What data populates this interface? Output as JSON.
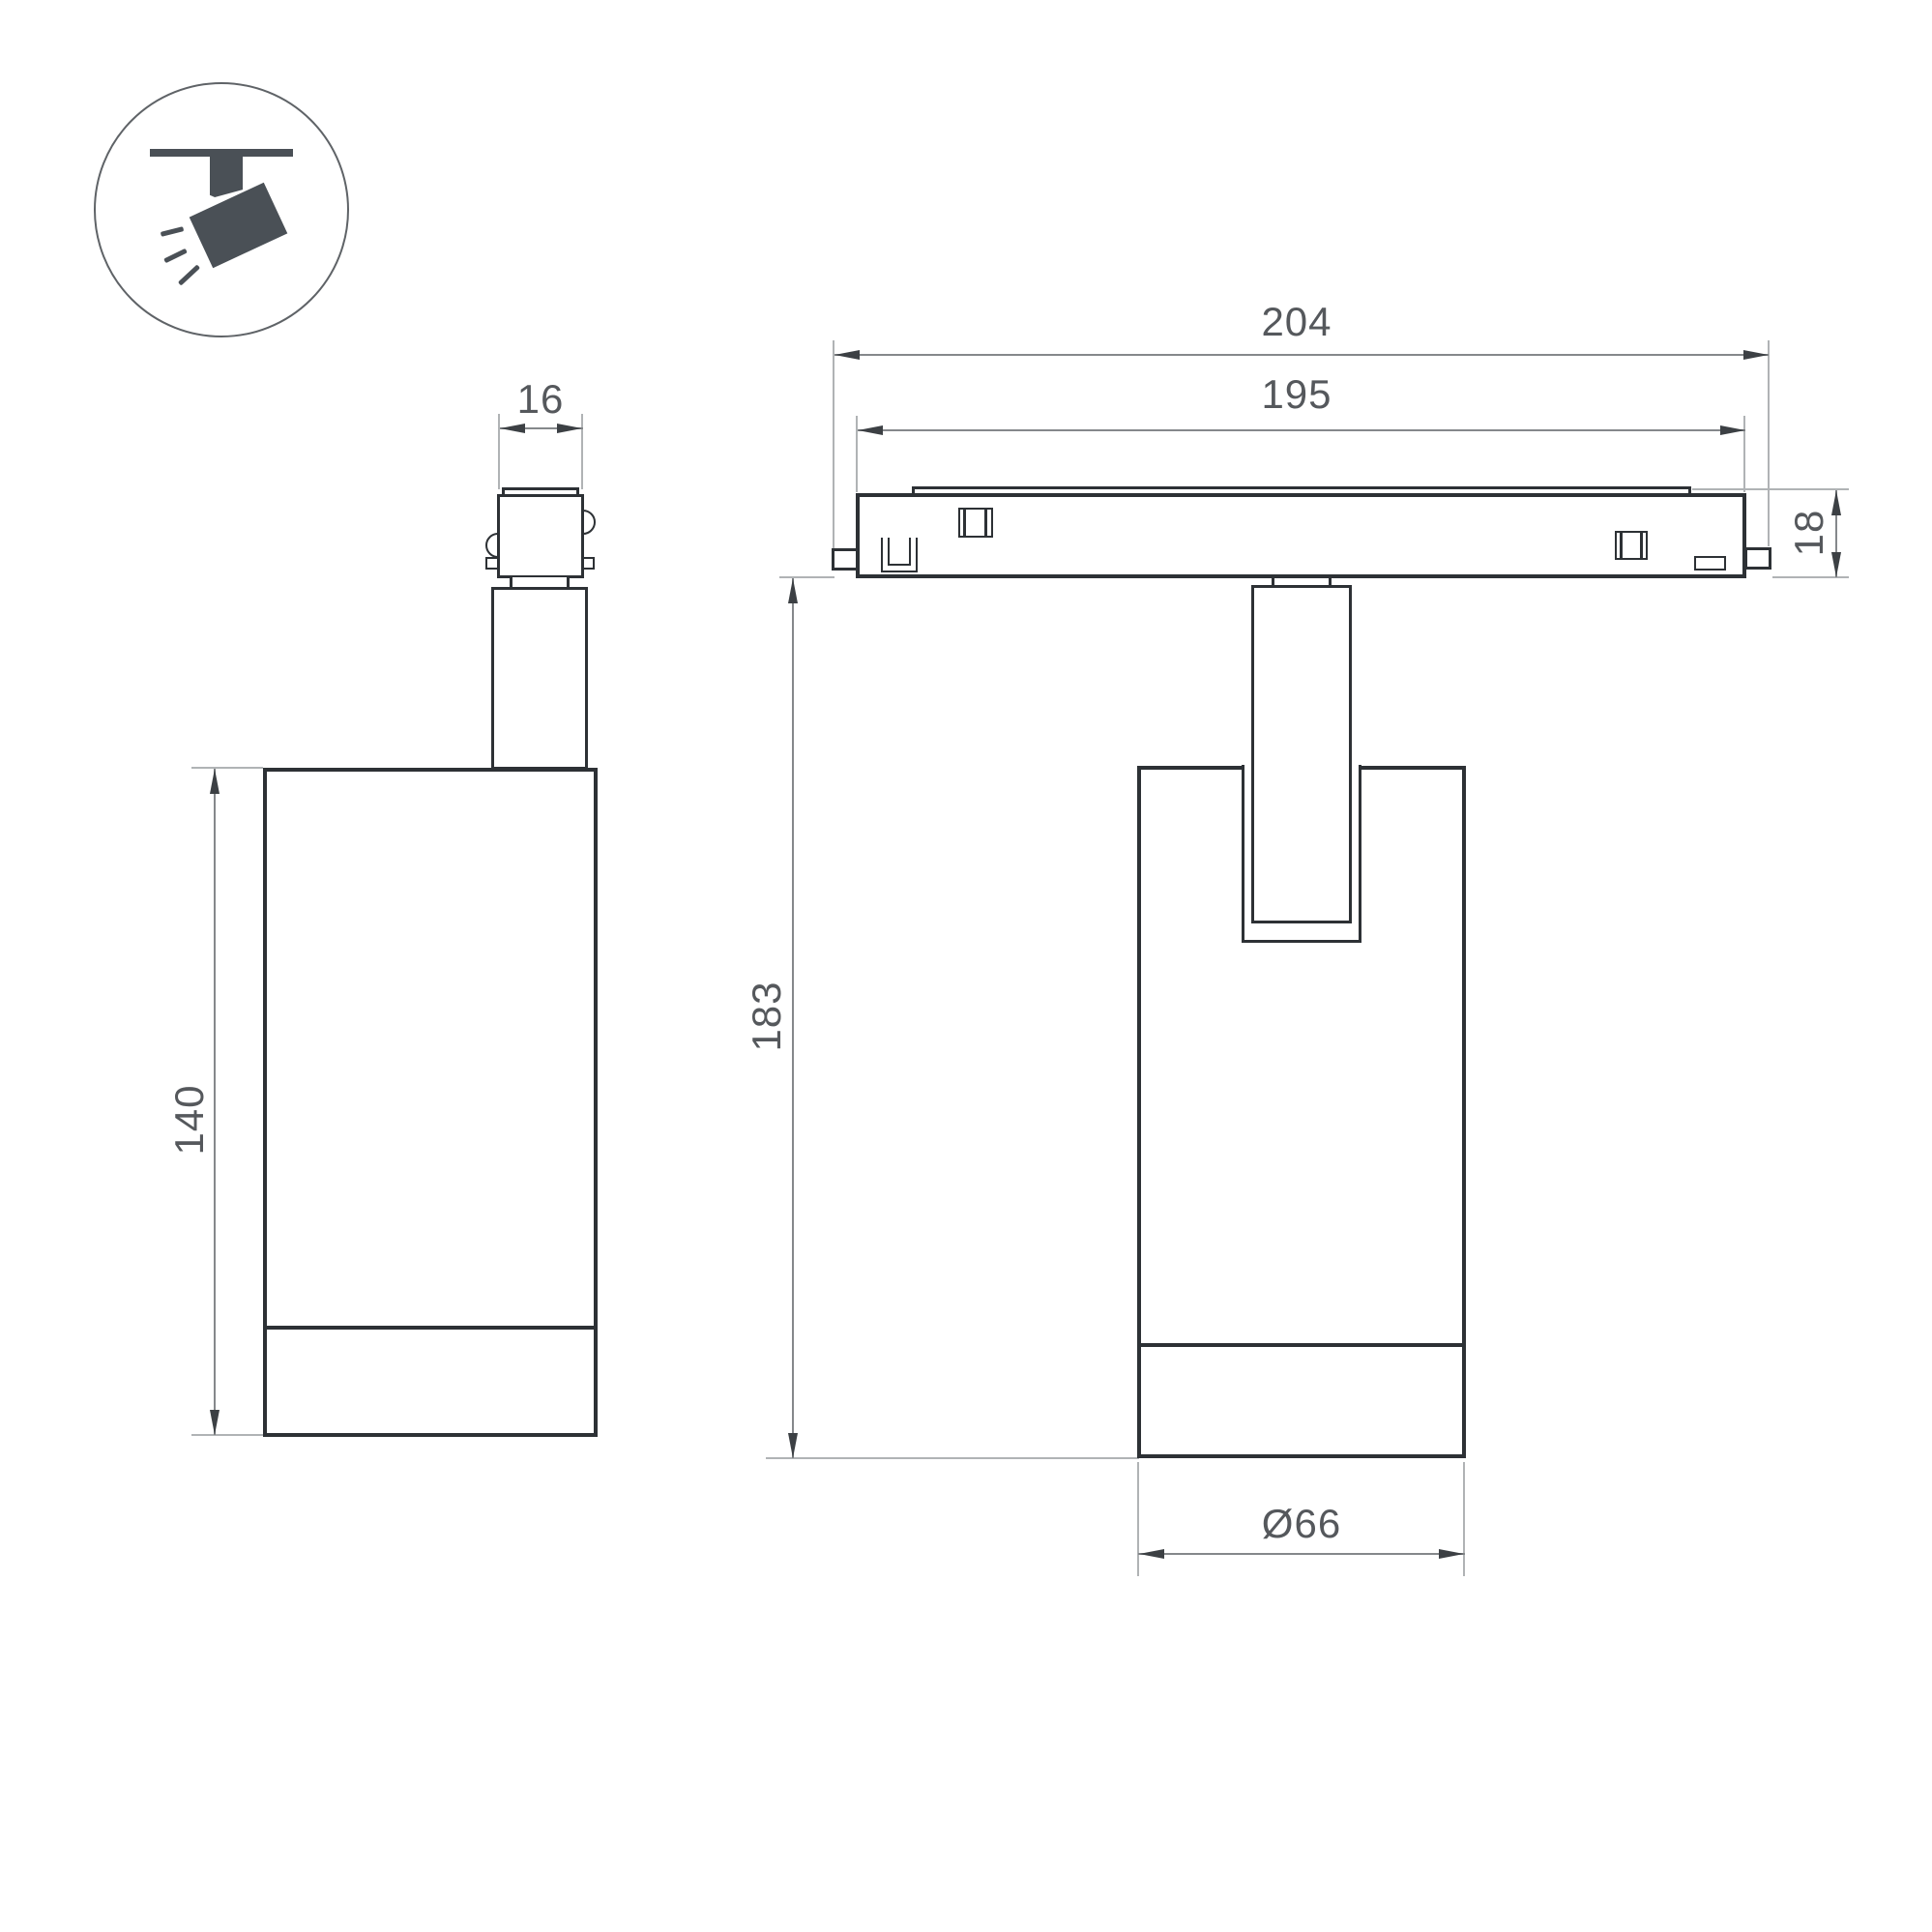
{
  "colors": {
    "background": "#ffffff",
    "outline": "#2d3135",
    "dim": "#85888b",
    "ext": "#b0b3b5",
    "arrow": "#3c4044",
    "text": "#55585c",
    "icon": "#4a5056",
    "ring": "#5f6367"
  },
  "icon": {
    "name": "track-spotlight-icon"
  },
  "dimensions": {
    "track_total": "204",
    "track_visible": "195",
    "adapter_width": "16",
    "track_height": "18",
    "overall_height": "183",
    "body_height": "140",
    "body_diameter": "Ø66"
  }
}
